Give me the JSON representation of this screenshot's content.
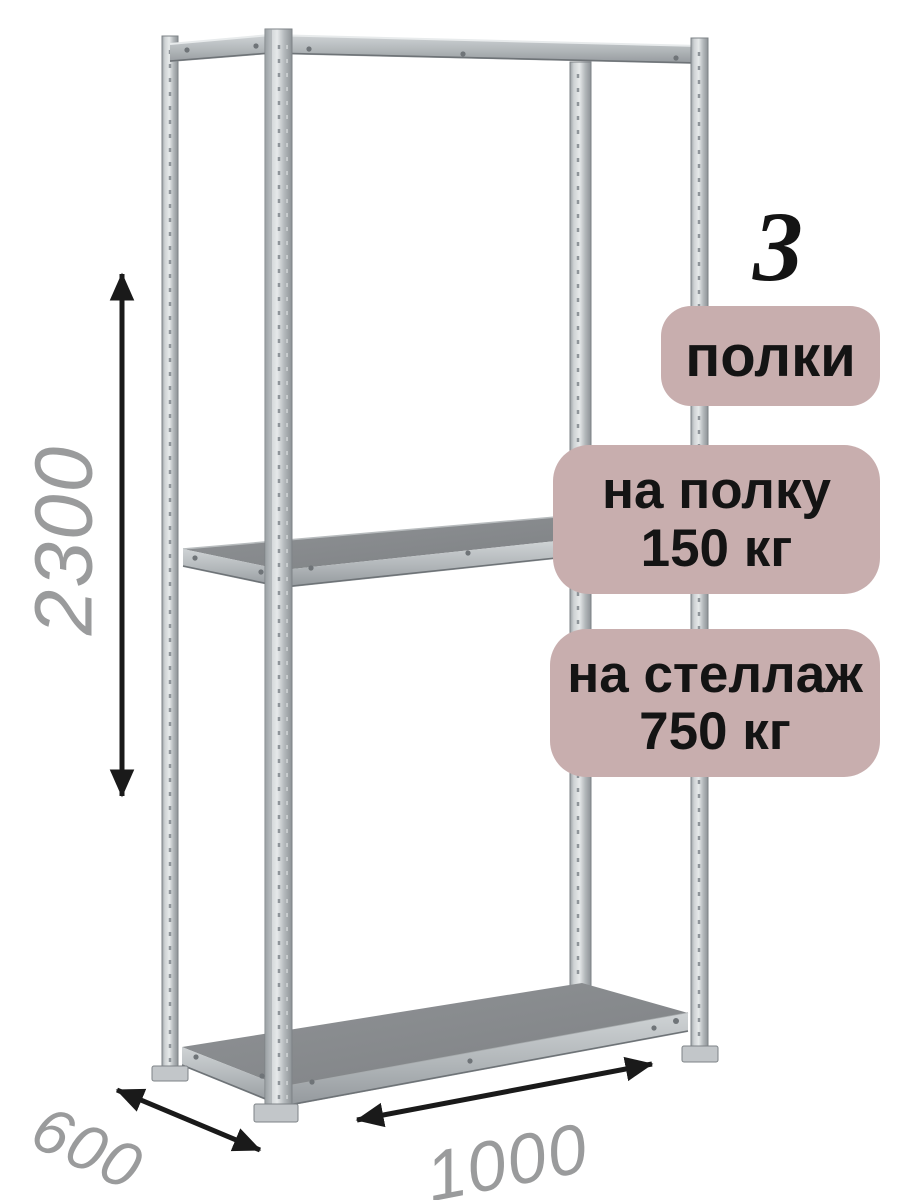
{
  "product": {
    "shelves_count": "3",
    "shelves_label": "полки",
    "shelf_load": {
      "line1": "на полку",
      "line2": "150 кг"
    },
    "rack_load": {
      "line1": "на стеллаж",
      "line2": "750 кг"
    }
  },
  "dimensions": {
    "height_mm": "2300",
    "depth_mm": "600",
    "width_mm": "1000"
  },
  "colors": {
    "badge_bg": "#c8aeae",
    "badge_text": "#141414",
    "dimension_text": "#9a9b9c",
    "arrow": "#1a1a1a",
    "metal_light": "#e3e6e7",
    "metal_mid": "#b5babd",
    "metal_dark": "#8d9296",
    "shelf_surface": "#8a8d8f"
  }
}
